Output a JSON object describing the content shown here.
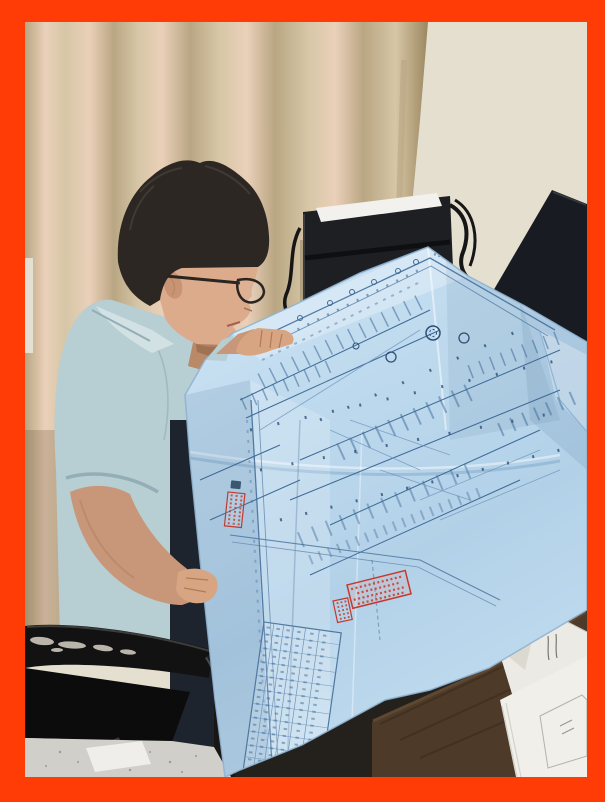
{
  "image_type": "photograph",
  "scene": {
    "subject": "man-reading-large-blueprint-at-desk",
    "objects": [
      "orange-photo-frame",
      "beige-curtain",
      "light-wall",
      "computer-tower",
      "paper-on-tower",
      "power-cables",
      "dark-monitor",
      "man-with-glasses",
      "light-blue-polo-shirt",
      "black-office-chair",
      "worn-armrest",
      "tiled-floor",
      "paper-on-floor",
      "wooden-desk",
      "white-envelope",
      "paper-stack",
      "light-blue-blueprint",
      "floor-plan-drawing",
      "schedule-table",
      "red-seal-stamps"
    ],
    "text_note": "no legible text visible; stamp and table characters are illegible marks"
  },
  "colors": {
    "frame": "#ff3b06",
    "wall": "#e5dfd0",
    "curtain": "#d6c6a6",
    "curtain_hi": "#ead0b9",
    "curtain_sh": "#b9a683",
    "hair": "#2c2722",
    "skin": "#dcab8c",
    "skin_arm": "#c89678",
    "shirt": "#b7ced3",
    "trousers": "#1d242e",
    "chair": "#121212",
    "scuff": "#d8d2c6",
    "floor": "#d0cfc9",
    "tower": "#1d1f23",
    "tower_paper": "#f2f1ed",
    "monitor": "#181b21",
    "desk": "#4e3a28",
    "paper": "#f1efe9",
    "blueprint": "#bfdaee",
    "blueprint_line": "#3f6a96",
    "stamp_red": "#c3392c"
  }
}
